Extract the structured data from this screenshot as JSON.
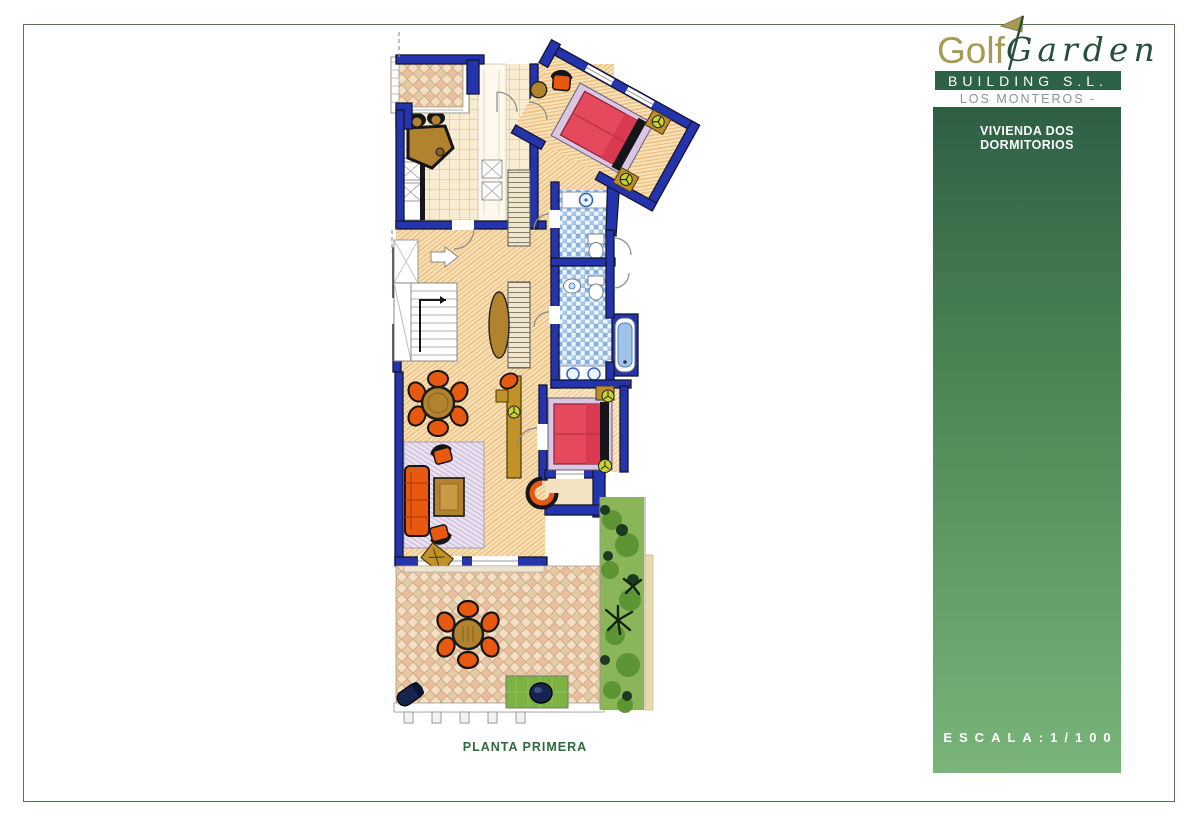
{
  "brand": {
    "logo_golf": "Golf",
    "logo_garden": "Garden",
    "building": "BUILDING S.L.",
    "location": "LOS MONTEROS - MARBELLA",
    "colors": {
      "gold": "#a69a55",
      "logo_green": "#26503a",
      "bar_green": "#2e6246",
      "location_gray": "#8e948e"
    }
  },
  "panel": {
    "title": "VIVIENDA DOS DORMITORIOS",
    "scale_label": "ESCALA:1/100",
    "gradient_top": "#2e5f44",
    "gradient_bottom": "#79b479"
  },
  "plan": {
    "caption": "PLANTA PRIMERA",
    "caption_color": "#2c6b3c",
    "colors": {
      "wall_blue": "#2434ac",
      "furniture_orange": "#e8590f",
      "bed_red": "#e5495e",
      "wood_brown": "#b1832f",
      "bath_tile_blue": "#82b1e2",
      "hedge_green": "#6aa33c",
      "terrace_lattice": "#e9bf9e"
    }
  },
  "page": {
    "border_color": "#587259",
    "background": "#ffffff"
  }
}
